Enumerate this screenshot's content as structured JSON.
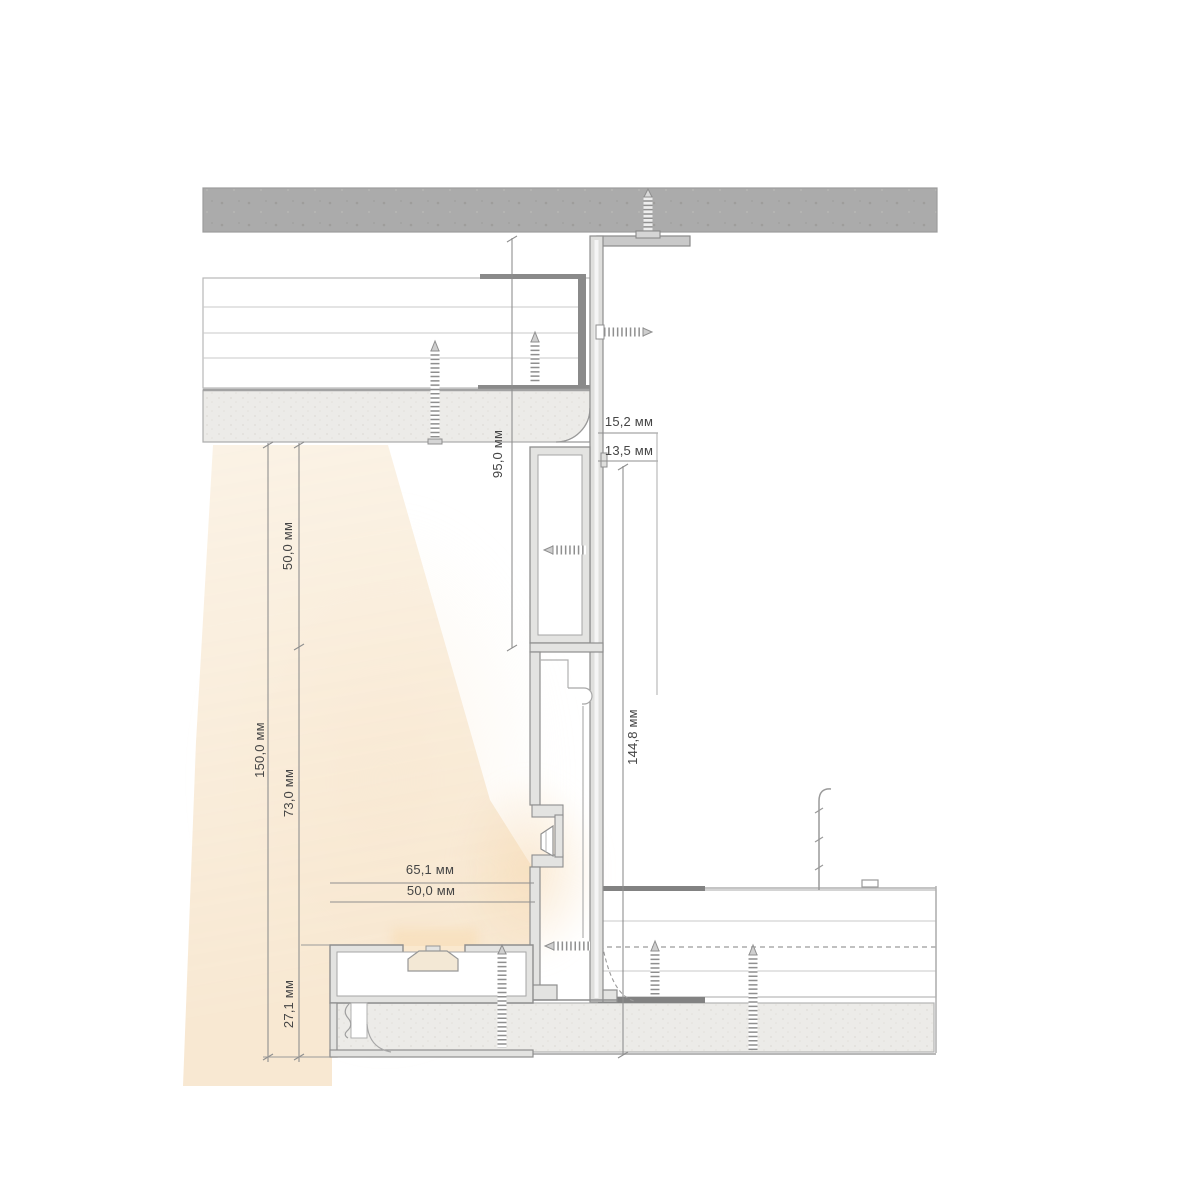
{
  "diagram": {
    "kind": "technical-section-drawing",
    "unit": "мм",
    "dims": {
      "top_gap": {
        "label": "15,2 мм",
        "value": 15.2
      },
      "bottom_gap": {
        "label": "13,5 мм",
        "value": 13.5
      },
      "upper_height": {
        "label": "95,0 мм",
        "value": 95.0
      },
      "profile_height": {
        "label": "144,8 мм",
        "value": 144.8
      },
      "offset_top": {
        "label": "50,0 мм",
        "value": 50.0
      },
      "total_height": {
        "label": "150,0 мм",
        "value": 150.0
      },
      "mid_offset": {
        "label": "73,0 мм",
        "value": 73.0
      },
      "plinth_height": {
        "label": "27,1 мм",
        "value": 27.1
      },
      "width_outer": {
        "label": "65,1 мм",
        "value": 65.1
      },
      "width_inner": {
        "label": "50,0 мм",
        "value": 50.0
      }
    },
    "colors": {
      "background": "#ffffff",
      "concrete": "#ababab",
      "plaster": "#ecebe8",
      "aluminium_wall": "#e3e3e1",
      "outline": "#8e8e8e",
      "dark_metal": "#828282",
      "dimension_line": "#8f8f8f",
      "text": "#454545",
      "light_glow": "#f6e3c9"
    }
  }
}
